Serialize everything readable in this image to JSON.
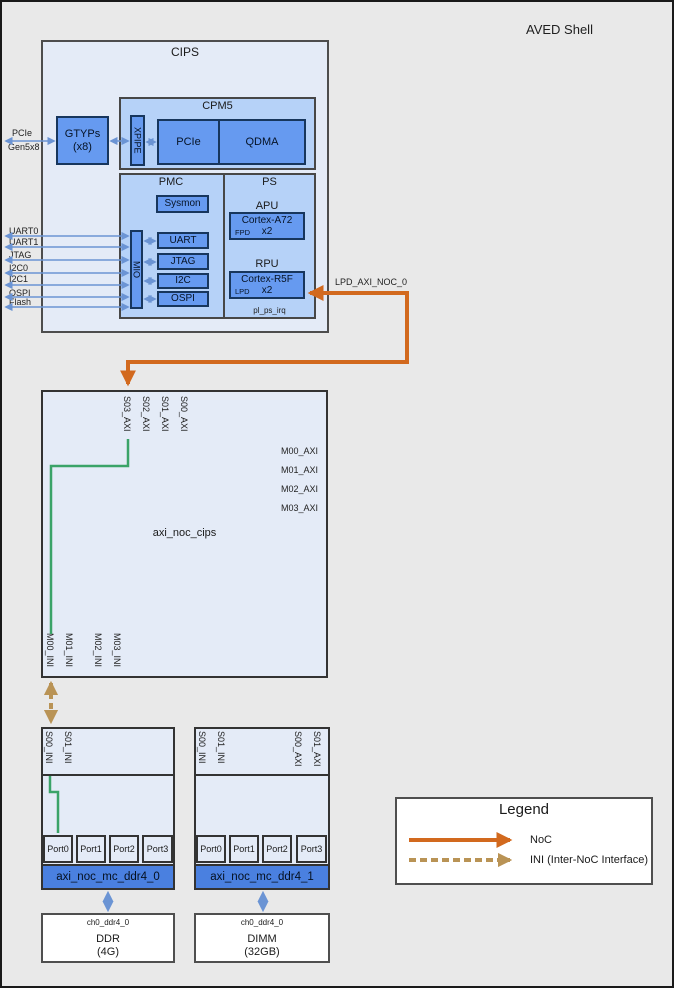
{
  "title": "AVED Shell",
  "colors": {
    "noc_orange": "#d2691e",
    "ini_tan": "#b99355",
    "axi_green": "#3aa368",
    "wire_blue": "#6b94d4",
    "block_bg_light": "#e4ebf7",
    "block_bg_mid": "#b6d2f8",
    "box_blue": "#669af0",
    "bar_blue": "#4a80e0"
  },
  "external_ports": {
    "pcie_line1": "PCIe",
    "pcie_line2": "Gen5x8",
    "signals": [
      "UART0",
      "UART1",
      "JTAG",
      "I2C0",
      "I2C1",
      "OSPI",
      "Flash"
    ]
  },
  "cips": {
    "label": "CIPS",
    "gtyps_line1": "GTYPs",
    "gtyps_line2": "(x8)",
    "xpipe": "XPIPE",
    "cpm5": {
      "label": "CPM5",
      "pcie": "PCIe",
      "qdma": "QDMA"
    },
    "pmc": {
      "label": "PMC",
      "sysmon": "Sysmon",
      "mio": "MIO",
      "peripherals": [
        "UART",
        "JTAG",
        "I2C",
        "OSPI"
      ]
    },
    "ps": {
      "label": "PS",
      "apu": {
        "label": "APU",
        "core": "Cortex-A72",
        "count": "x2",
        "domain": "FPD"
      },
      "rpu": {
        "label": "RPU",
        "core": "Cortex-R5F",
        "count": "x2",
        "domain": "LPD"
      },
      "irq": "pl_ps_irq"
    }
  },
  "noc_connection_label": "LPD_AXI_NOC_0",
  "axi_noc_cips": {
    "label": "axi_noc_cips",
    "slave_ports": [
      "S03_AXI",
      "S02_AXI",
      "S01_AXI",
      "S00_AXI"
    ],
    "master_axi_ports": [
      "M00_AXI",
      "M01_AXI",
      "M02_AXI",
      "M03_AXI"
    ],
    "master_ini_ports": [
      "M00_INI",
      "M01_INI",
      "M02_INI",
      "M03_INI"
    ]
  },
  "mc0": {
    "label": "axi_noc_mc_ddr4_0",
    "slave_ini_ports": [
      "S00_INI",
      "S01_INI"
    ],
    "ports": [
      "Port0",
      "Port1",
      "Port2",
      "Port3"
    ]
  },
  "mc1": {
    "label": "axi_noc_mc_ddr4_1",
    "slave_ini_ports": [
      "S00_INI",
      "S01_INI"
    ],
    "slave_axi_ports": [
      "S00_AXI",
      "S01_AXI"
    ],
    "ports": [
      "Port0",
      "Port1",
      "Port2",
      "Port3"
    ]
  },
  "ddr": {
    "channel": "ch0_ddr4_0",
    "name": "DDR",
    "size": "(4G)"
  },
  "dimm": {
    "channel": "ch0_ddr4_0",
    "name": "DIMM",
    "size": "(32GB)"
  },
  "legend": {
    "title": "Legend",
    "noc_label": "NoC",
    "ini_label": "INI (Inter-NoC Interface)"
  }
}
